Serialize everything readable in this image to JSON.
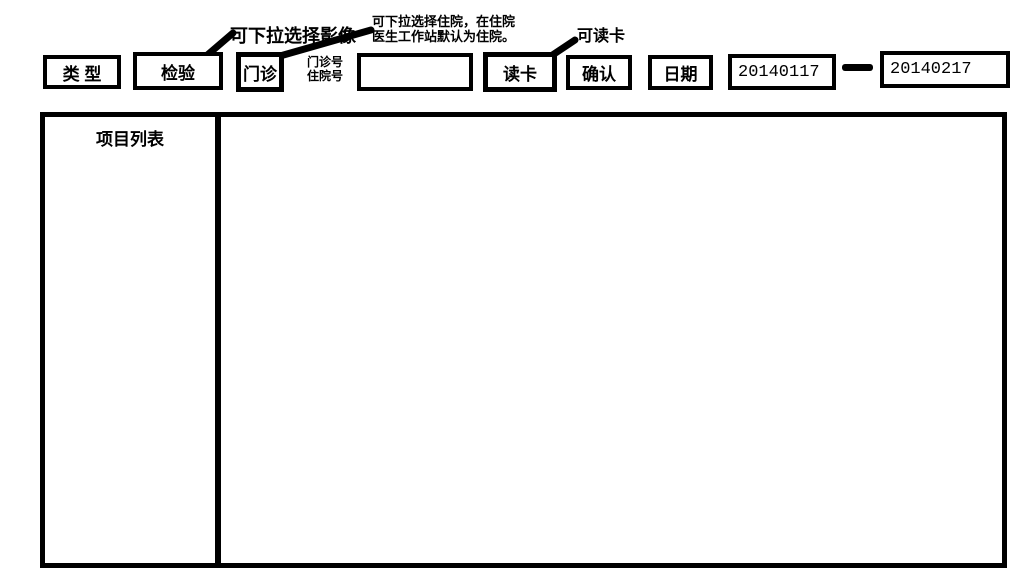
{
  "toolbar": {
    "type_label": "类 型",
    "exam_type": "检验",
    "visit_type": "门诊",
    "patient_id_label_line1": "门诊号",
    "patient_id_label_line2": "住院号",
    "patient_id_value": "",
    "read_card": "读卡",
    "confirm": "确认",
    "date_label": "日期",
    "date_start": "20140117",
    "date_end": "20140217"
  },
  "annotations": {
    "exam_type_note": "可下拉选择影像",
    "visit_type_note_line1": "可下拉选择住院，在住院",
    "visit_type_note_line2": "医生工作站默认为住院。",
    "read_card_note": "可读卡"
  },
  "panels": {
    "item_list_title": "项目列表"
  },
  "colors": {
    "ink": "#000000",
    "background": "#ffffff"
  }
}
